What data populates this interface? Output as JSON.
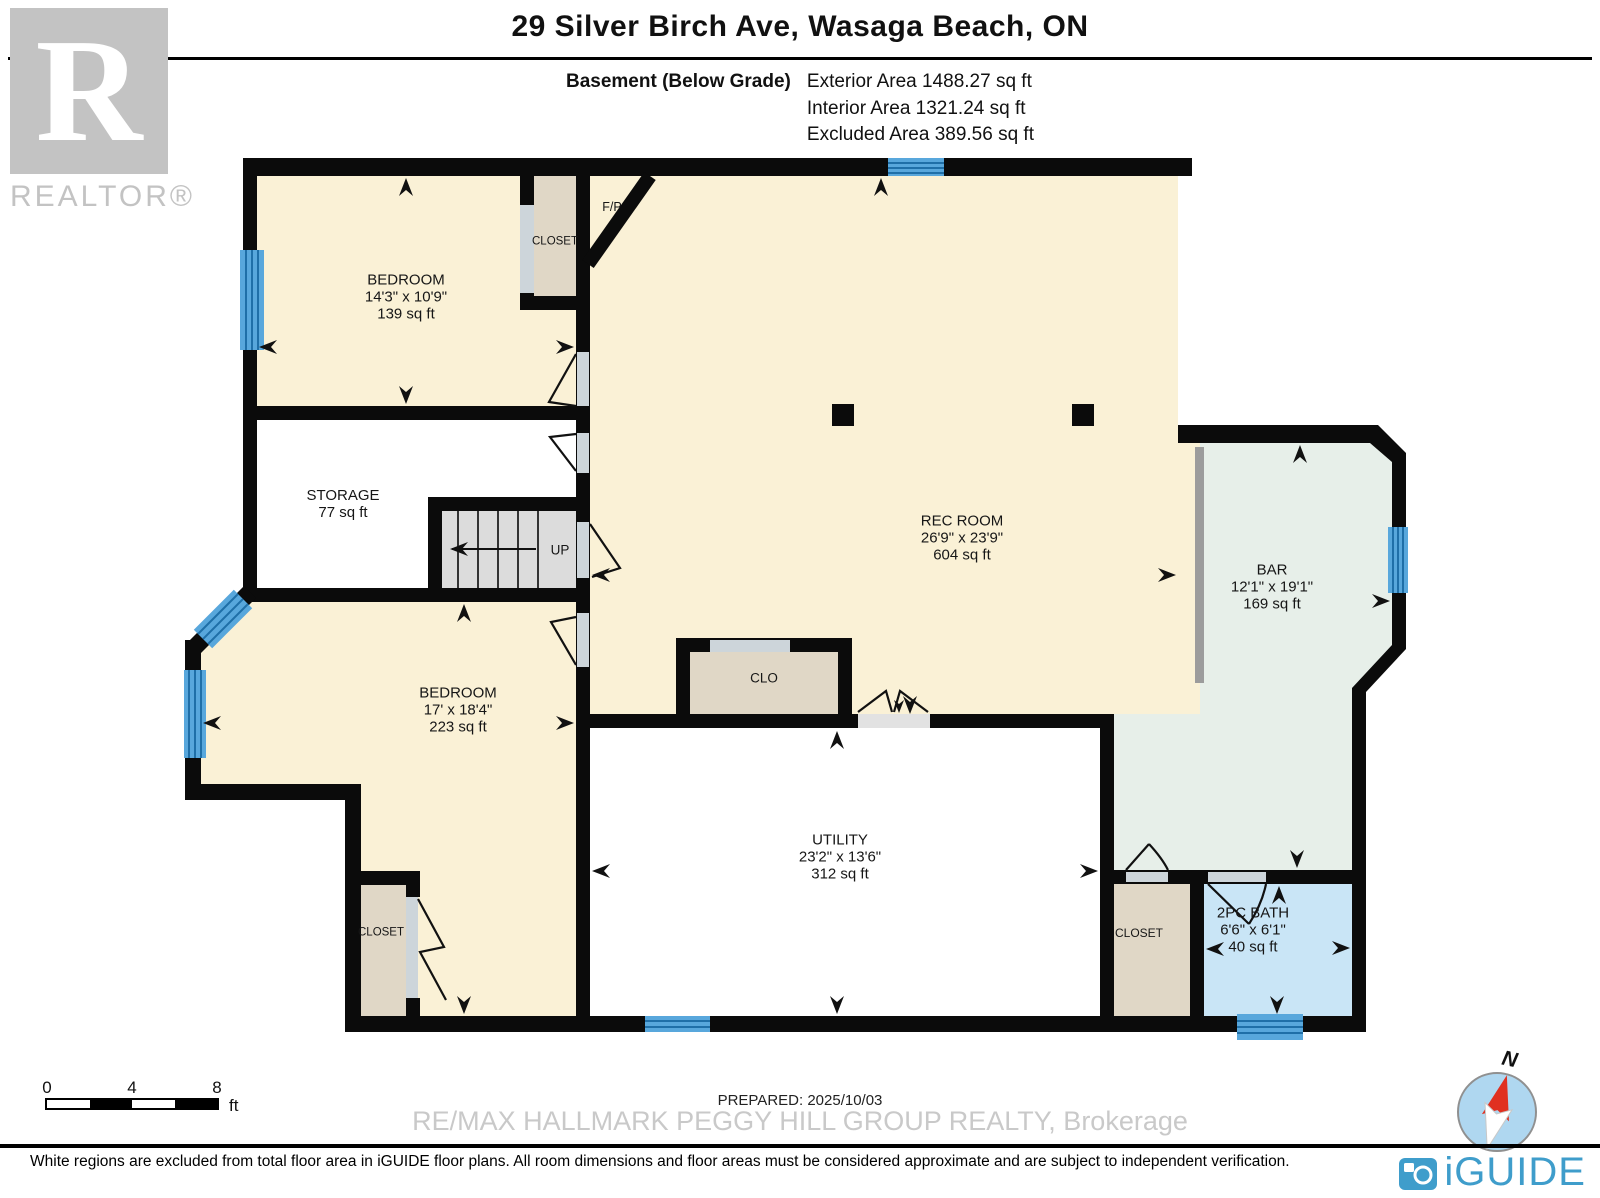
{
  "header": {
    "title": "29 Silver Birch Ave, Wasaga Beach, ON",
    "floor_label": "Basement (Below Grade)",
    "area_lines": [
      "Exterior Area 1488.27 sq ft",
      "Interior Area 1321.24 sq ft",
      "Excluded Area 389.56 sq ft"
    ]
  },
  "watermarks": {
    "realtor_logo_letter": "R",
    "realtor_text": "REALTOR®",
    "brokerage": "RE/MAX HALLMARK PEGGY HILL GROUP REALTY, Brokerage"
  },
  "rooms": {
    "bedroom1": {
      "name": "BEDROOM",
      "dims": "14'3\" x 10'9\"",
      "area": "139 sq ft"
    },
    "closet1": {
      "name": "CLOSET"
    },
    "fireplace": {
      "name": "F/P"
    },
    "rec_room": {
      "name": "REC ROOM",
      "dims": "26'9\" x 23'9\"",
      "area": "604 sq ft"
    },
    "storage": {
      "name": "STORAGE",
      "area": "77 sq ft"
    },
    "stairs": {
      "name": "UP"
    },
    "bedroom2": {
      "name": "BEDROOM",
      "dims": "17' x 18'4\"",
      "area": "223 sq ft"
    },
    "closet2": {
      "name": "CLOSET"
    },
    "clo": {
      "name": "CLO"
    },
    "utility": {
      "name": "UTILITY",
      "dims": "23'2\" x 13'6\"",
      "area": "312 sq ft"
    },
    "bar": {
      "name": "BAR",
      "dims": "12'1\" x 19'1\"",
      "area": "169 sq ft"
    },
    "closet3": {
      "name": "CLOSET"
    },
    "bath": {
      "name": "2PC BATH",
      "dims": "6'6\" x 6'1\"",
      "area": "40 sq ft"
    }
  },
  "scale_bar": {
    "ticks": [
      "0",
      "4",
      "8"
    ],
    "unit": "ft"
  },
  "compass": {
    "north_label": "N"
  },
  "footer": {
    "prepared": "PREPARED: 2025/10/03",
    "disclaimer": "White regions are excluded from total floor area in iGUIDE floor plans. All room dimensions and floor areas must be considered approximate and are subject to independent verification.",
    "brand": "iGUIDE"
  },
  "colors": {
    "wall": "#0b0b0b",
    "room_cream": "#FAF1D6",
    "closet_tan": "#E0D7C6",
    "bar_sage": "#E7EFE9",
    "bath_blue": "#C9E5F6",
    "window_blue": "#58A7DC",
    "window_line": "#1F6FA8",
    "stairs_gray": "#DCDCDC",
    "door_gray": "#CDD5DA",
    "brand_blue": "#3F9DCB"
  }
}
